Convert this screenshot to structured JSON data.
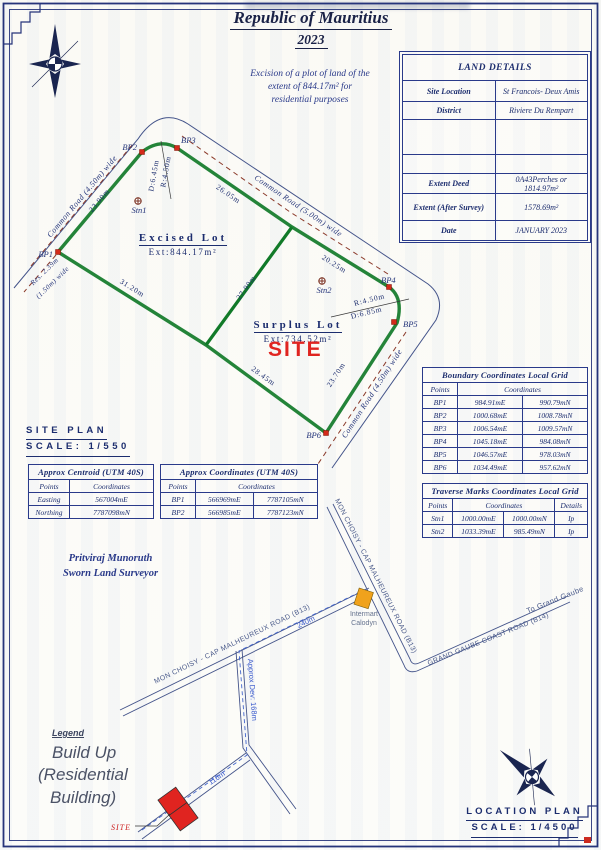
{
  "page": {
    "title": "Republic of Mauritius",
    "year": "2023",
    "purpose_line1": "Excision of a plot of land of the",
    "purpose_line2": "extent of 844.17m² for",
    "purpose_line3": "residential purposes"
  },
  "land_details": {
    "title": "LAND DETAILS",
    "site_location_label": "Site Location",
    "site_location_value": "St Francois- Deux Amis",
    "district_label": "District",
    "district_value": "Riviere Du Rempart",
    "extent_deed_label": "Extent Deed",
    "extent_deed_value": "0A43Perches or 1814.97m²",
    "extent_survey_label": "Extent (After Survey)",
    "extent_survey_value": "1578.69m²",
    "date_label": "Date",
    "date_value": "JANUARY 2023"
  },
  "site_plan": {
    "heading": "SITE PLAN",
    "scale": "SCALE: 1/550",
    "excised_lot_name": "Excised Lot",
    "excised_lot_ext": "Ext:844.17m²",
    "surplus_lot_name": "Surplus Lot",
    "surplus_lot_ext": "Ext:734.52m²",
    "site_marker": "SITE",
    "bp1": "BP1",
    "bp2": "BP2",
    "bp3": "BP3",
    "bp4": "BP4",
    "bp5": "BP5",
    "bp6": "BP6",
    "stn1": "Stn1",
    "stn2": "Stn2",
    "dim_bp1_bp2": "23.90m",
    "dim_bp3_j": "26.05m",
    "dim_j_bp4": "20.25m",
    "dim_bp1_v": "31.20m",
    "dim_v_bp6": "28.45m",
    "dim_bp5_bp6": "23.70m",
    "dim_divider": "27.90m",
    "curve1_r": "R:4.50m",
    "curve1_d": "D:6.45m",
    "curve2_r": "R:4.50m",
    "curve2_d": "D:6.85m",
    "road_topleft": "Common Road (4.50m) wide",
    "road_topright": "Common Road (5.00m) wide",
    "road_right": "Common Road (4.50m) wide",
    "reserved_line1": "Res. 2.39m",
    "reserved_line2": "(1.50m) wide"
  },
  "tables": {
    "centroid": {
      "title": "Approx Centroid (UTM 40S)",
      "col_points": "Points",
      "col_coords": "Coordinates",
      "rows": [
        {
          "label": "Easting",
          "value": "567004mE"
        },
        {
          "label": "Northing",
          "value": "7787098mN"
        }
      ]
    },
    "approx": {
      "title": "Approx Coordinates (UTM 40S)",
      "col_points": "Points",
      "col_coords": "Coordinates",
      "rows": [
        {
          "point": "BP1",
          "e": "566969mE",
          "n": "7787105mN"
        },
        {
          "point": "BP2",
          "e": "566985mE",
          "n": "7787123mN"
        }
      ]
    },
    "boundary": {
      "title": "Boundary Coordinates Local Grid",
      "col_points": "Points",
      "col_coords": "Coordinates",
      "rows": [
        {
          "point": "BP1",
          "e": "984.91mE",
          "n": "990.79mN"
        },
        {
          "point": "BP2",
          "e": "1000.68mE",
          "n": "1008.78mN"
        },
        {
          "point": "BP3",
          "e": "1006.54mE",
          "n": "1009.57mN"
        },
        {
          "point": "BP4",
          "e": "1045.18mE",
          "n": "984.08mN"
        },
        {
          "point": "BP5",
          "e": "1046.57mE",
          "n": "978.03mN"
        },
        {
          "point": "BP6",
          "e": "1034.49mE",
          "n": "957.62mN"
        }
      ]
    },
    "traverse": {
      "title": "Traverse Marks Coordinates Local Grid",
      "col_points": "Points",
      "col_coords": "Coordinates",
      "col_details": "Details",
      "rows": [
        {
          "point": "Stn1",
          "e": "1000.00mE",
          "n": "1000.00mN",
          "details": "Ip"
        },
        {
          "point": "Stn2",
          "e": "1033.39mE",
          "n": "985.49mN",
          "details": "Ip"
        }
      ]
    }
  },
  "surveyor": {
    "name": "Pritviraj Munoruth",
    "role": "Sworn Land Surveyor"
  },
  "location_plan": {
    "heading": "LOCATION PLAN",
    "scale": "SCALE: 1/4500",
    "road_b13": "MON CHOISY - CAP MALHEUREUX ROAD (B13)",
    "road_b14": "GRAND GAUBE COAST ROAD (B14)",
    "to_grand_gaube": "To Grand Gaube",
    "dist_240": "240m",
    "dist_168": "Approx Dev: 168m",
    "dist_116": "116m",
    "intermart_line1": "Intermart",
    "intermart_line2": "Calodyn",
    "site_marker": "SITE",
    "legend_title": "Legend",
    "legend_line1": "Build Up",
    "legend_line2": "(Residential",
    "legend_line3": "Building)"
  },
  "colors": {
    "boundary_green": "#117a28",
    "bp_red": "#d42a1a",
    "site_red": "#e02420",
    "navy": "#1c2d6e",
    "road_gray": "#44548a",
    "dash_maroon": "#8b3a2a",
    "blue_note": "#3a5acc",
    "building_orange": "#f0a21c"
  }
}
